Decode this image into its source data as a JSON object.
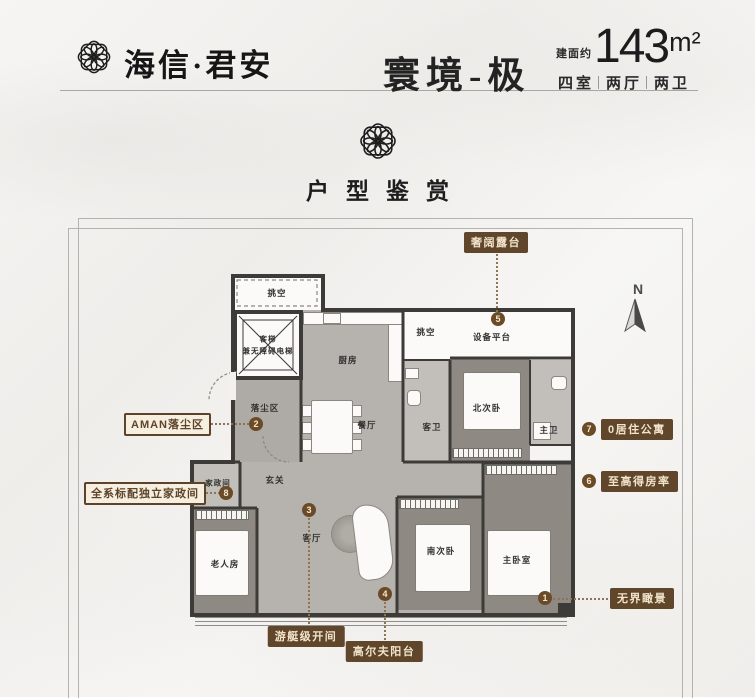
{
  "header": {
    "brand": "海信·君安",
    "series_title": "寰境-极",
    "area_prefix": "建面约",
    "area_value": "143",
    "area_unit": "m²",
    "spec": {
      "rooms": "四室",
      "halls": "两厅",
      "baths": "两卫"
    }
  },
  "section_title": "户型鉴赏",
  "compass_label": "N",
  "rooms": {
    "void_top": "挑空",
    "elevator_line1": "客梯",
    "elevator_line2": "兼无障碍电梯",
    "kitchen": "厨房",
    "void_small": "挑空",
    "equipment_platform": "设备平台",
    "dust_area": "落尘区",
    "dining": "餐厅",
    "guest_bath": "客卫",
    "north_bedroom": "北次卧",
    "master_bath": "主卫",
    "foyer": "玄关",
    "living": "客厅",
    "housekeeping": "家政间",
    "elder_room": "老人房",
    "south_bedroom": "南次卧",
    "master_bedroom": "主卧室"
  },
  "markers": {
    "m1": "1",
    "m2": "2",
    "m3": "3",
    "m4": "4",
    "m5": "5",
    "m6": "6",
    "m7": "7",
    "m8": "8"
  },
  "callouts": {
    "terrace": "奢阔露台",
    "aman": "AMAN落尘区",
    "housekeeping_full": "全系标配独立家政间",
    "yacht_bay": "游艇级开间",
    "golf_balcony": "高尔夫阳台",
    "view": "无界瞰景",
    "apartment": "0居住公寓",
    "ratio": "至高得房率"
  },
  "colors": {
    "accent_brown": "#60462a",
    "wall_dark": "#3c3b38",
    "floor_gray": "#b6b3ae",
    "floor_wood": "#8e8a83",
    "callout_text": "#f1e4cb"
  }
}
